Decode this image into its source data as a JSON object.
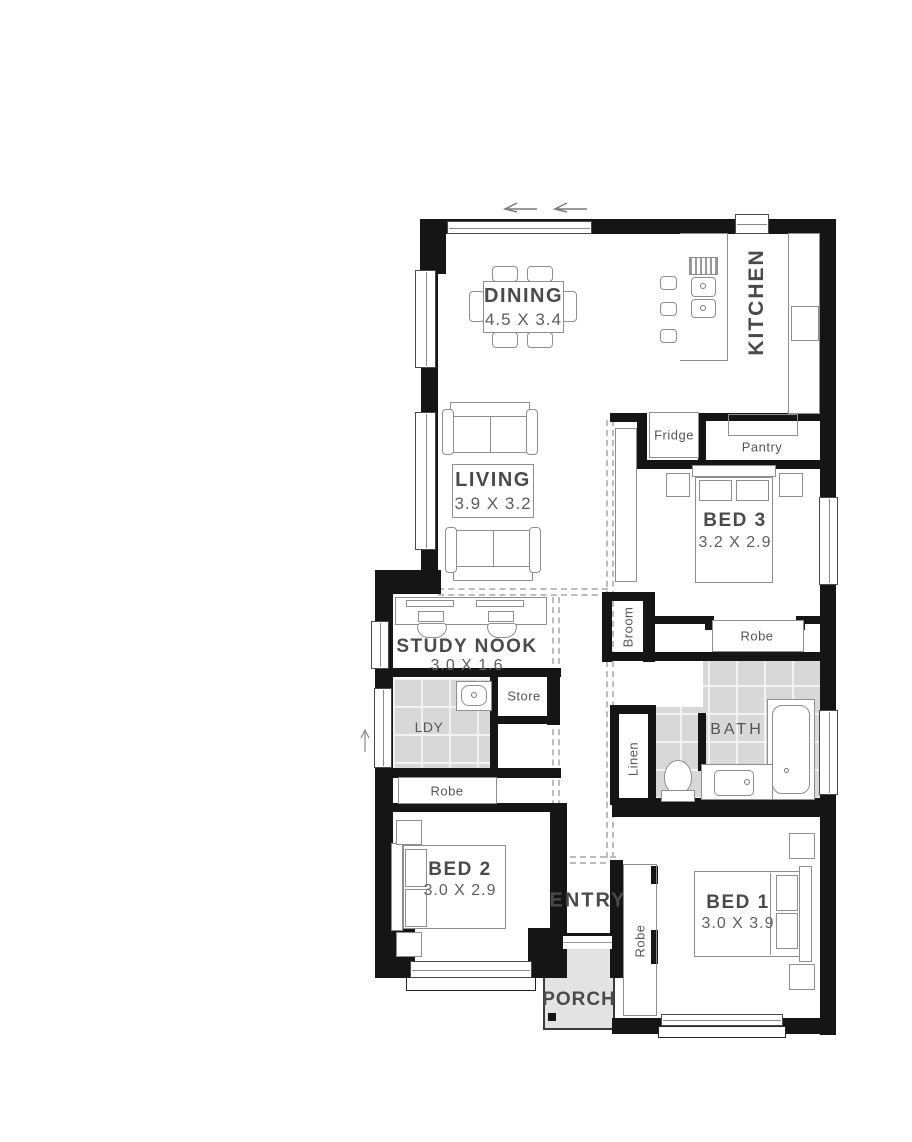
{
  "plan": {
    "rooms": {
      "dining": {
        "name": "DINING",
        "dims": "4.5 X 3.4"
      },
      "kitchen": {
        "name": "KITCHEN"
      },
      "living": {
        "name": "LIVING",
        "dims": "3.9 X 3.2"
      },
      "bed3": {
        "name": "BED 3",
        "dims": "3.2 X 2.9"
      },
      "study_nook": {
        "name": "STUDY NOOK",
        "dims": "3.0 X 1.6"
      },
      "laundry": {
        "name": "LDY"
      },
      "store": {
        "name": "Store"
      },
      "bath": {
        "name": "BATH"
      },
      "bed2": {
        "name": "BED 2",
        "dims": "3.0 X 2.9"
      },
      "bed1": {
        "name": "BED 1",
        "dims": "3.0 X 3.9"
      },
      "entry": {
        "name": "ENTRY"
      },
      "porch": {
        "name": "PORCH"
      }
    },
    "storage": {
      "fridge": "Fridge",
      "pantry": "Pantry",
      "robe_bed3": "Robe",
      "robe_bed2": "Robe",
      "robe_bed1": "Robe",
      "broom": "Broom",
      "linen": "Linen"
    },
    "colors": {
      "wall": "#151515",
      "furniture_outline": "#8e8e8e",
      "tile_fill": "#d8d8d8",
      "porch_fill": "#e3e3e3",
      "label": "#4a4a4a"
    }
  }
}
